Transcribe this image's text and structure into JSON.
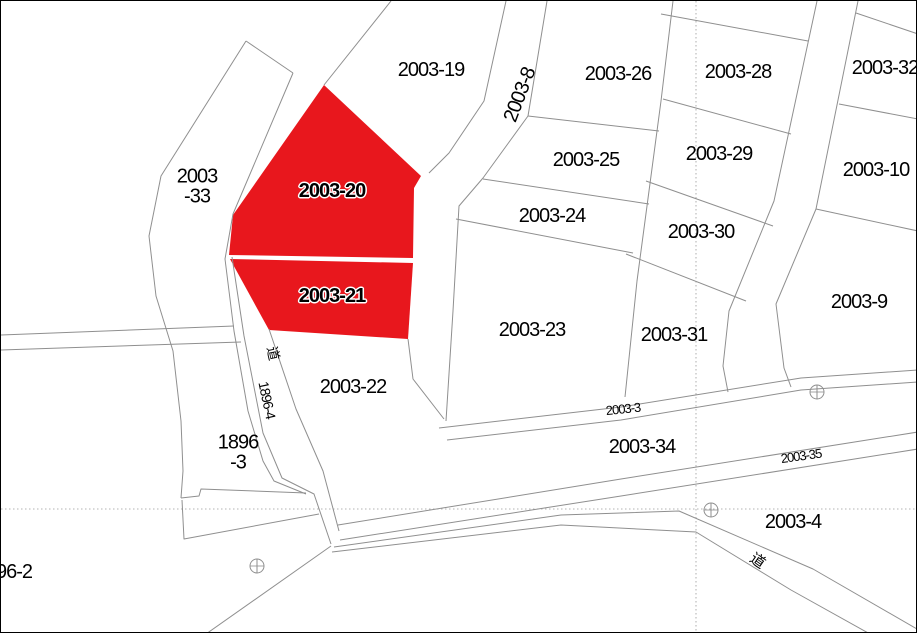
{
  "map": {
    "title": "cadastral-parcel-map",
    "background_color": "#ffffff",
    "boundary_line_color": "#8f8f8f",
    "grid_line_color": "#9a9a9a",
    "highlight_color": "#e8171d",
    "highlighted_parcels": [
      "2003-20",
      "2003-21"
    ],
    "labels": [
      {
        "text": "2003-19",
        "x": 430,
        "y": 69
      },
      {
        "text": "2003-26",
        "x": 617,
        "y": 73
      },
      {
        "text": "2003-28",
        "x": 737,
        "y": 71
      },
      {
        "text": "2003-32",
        "x": 884,
        "y": 67
      },
      {
        "text": "2003-25",
        "x": 585,
        "y": 159
      },
      {
        "text": "2003-29",
        "x": 718,
        "y": 153
      },
      {
        "text": "2003-10",
        "x": 875,
        "y": 169
      },
      {
        "text": "2003-24",
        "x": 551,
        "y": 215
      },
      {
        "text": "2003-30",
        "x": 700,
        "y": 231
      },
      {
        "text": "2003-20",
        "x": 331,
        "y": 190,
        "halo": true
      },
      {
        "text": "2003-21",
        "x": 331,
        "y": 295,
        "halo": true
      },
      {
        "text": "2003-9",
        "x": 858,
        "y": 301
      },
      {
        "text": "2003-23",
        "x": 531,
        "y": 329
      },
      {
        "text": "2003-31",
        "x": 673,
        "y": 334
      },
      {
        "text": "2003-22",
        "x": 352,
        "y": 386
      },
      {
        "text": "2003-34",
        "x": 641,
        "y": 446
      },
      {
        "text": "2003-4",
        "x": 792,
        "y": 521
      },
      {
        "text": "2003-33",
        "lines": [
          "2003",
          "-33"
        ],
        "x": 196,
        "y": 186
      },
      {
        "text": "1896-3",
        "lines": [
          "1896",
          "-3"
        ],
        "x": 237,
        "y": 452
      },
      {
        "text": "96-2",
        "x": 13,
        "y": 571
      },
      {
        "text": "2003-8",
        "x": 519,
        "y": 94,
        "rot": -69
      },
      {
        "text": "2003-3",
        "x": 622,
        "y": 408,
        "rot": -6,
        "size": 13
      },
      {
        "text": "2003-35",
        "x": 800,
        "y": 455,
        "rot": -8,
        "size": 13
      },
      {
        "text": "1896-4",
        "x": 266,
        "y": 399,
        "rot": 78,
        "size": 14
      },
      {
        "text": "道",
        "x": 272,
        "y": 352,
        "rot": 78,
        "size": 14
      },
      {
        "text": "道",
        "x": 756,
        "y": 560,
        "rot": 35,
        "size": 15
      }
    ],
    "survey_markers": [
      {
        "x": 256,
        "y": 565
      },
      {
        "x": 710,
        "y": 509
      },
      {
        "x": 816,
        "y": 391
      }
    ]
  }
}
